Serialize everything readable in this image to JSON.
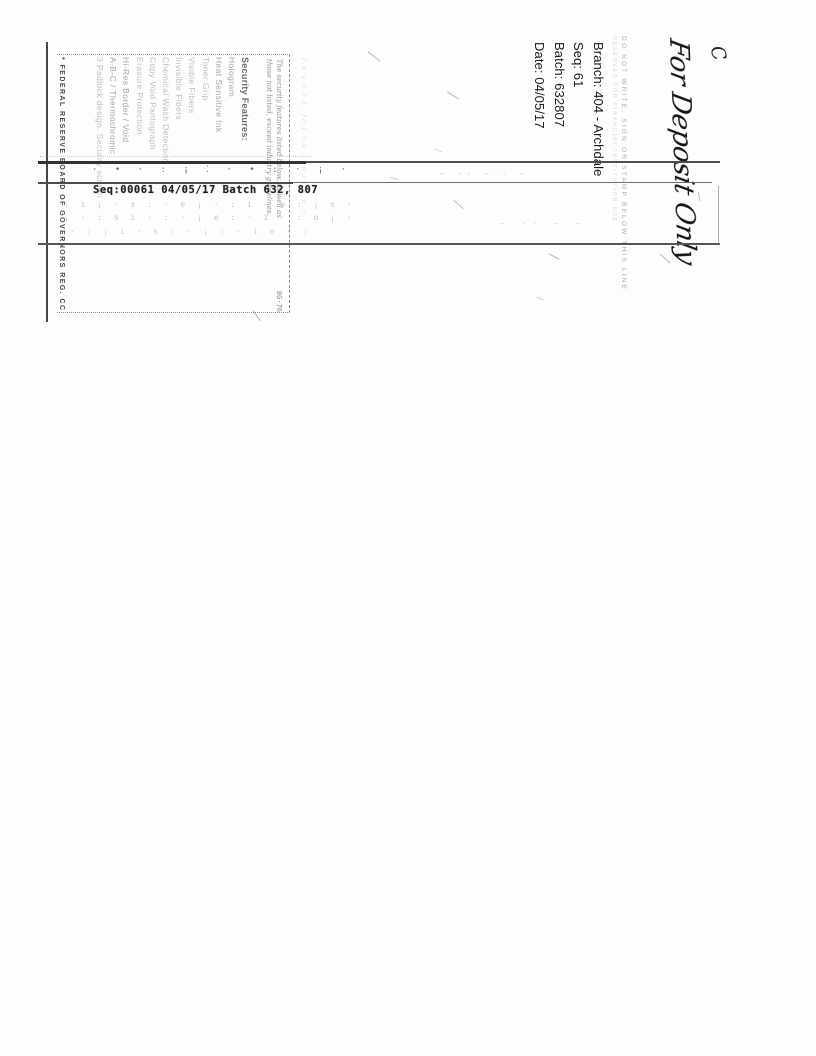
{
  "colors": {
    "ink": "#1a1a1a",
    "faint_ink": "#8b8b8b",
    "line": "#4e4e4e",
    "paper": "#fdfdfc"
  },
  "handwriting": {
    "flourish": "C",
    "text": "For Deposit Only"
  },
  "notice": {
    "line1": "DO NOT WRITE, SIGN OR STAMP BELOW THIS LINE",
    "line2": "RESERVED FOR FINANCIAL INSTITUTION USE"
  },
  "meta": {
    "branch": "Branch: 404 - Archdale",
    "seq": "Seq: 61",
    "batch": "Batch: 632807",
    "date": "Date: 04/05/17"
  },
  "stamp": {
    "marks": "· • · : ¡ ⁚ · • : · ¡ ·",
    "text": "Seq:00061 04/05/17 Batch 632, 807",
    "garble1": ": i ¡ · s : · e ¡ · : i · o : ¡ s ·",
    "garble2": "¡ · : s i · : · ¡ e : · i · : o ¡ ·",
    "garble3": "· : ¡ i · s : · ¡ : · i e · :",
    "dashes_top": "– ‐‐ – ‐ –",
    "dashes_mid": "– ·· –  –"
  },
  "security_box": {
    "tagline1": "The security features listed below, as well as",
    "tagline2": "those not listed, exceed industry guidelines.",
    "form_code": "BG-76",
    "heading": "Security Features:",
    "features": [
      "Hologram",
      "Heat Sensitive Ink",
      "Toner Grip",
      "Visible Fibers",
      "Invisible Fibers",
      "Chemical Wash Detection",
      "Copy Void Pantograph",
      "Erasure Protection",
      "Hi-Res Border / Void",
      "A-B-C / Thermochromic",
      "3 Padlock design. Security screen"
    ],
    "compliance": "* FEDERAL RESERVE BOARD OF GOVERNORS REG. CC",
    "ghost_column": "t.e s.c.r.t, fe.t.r.s . sp.ty g.n.r ."
  }
}
